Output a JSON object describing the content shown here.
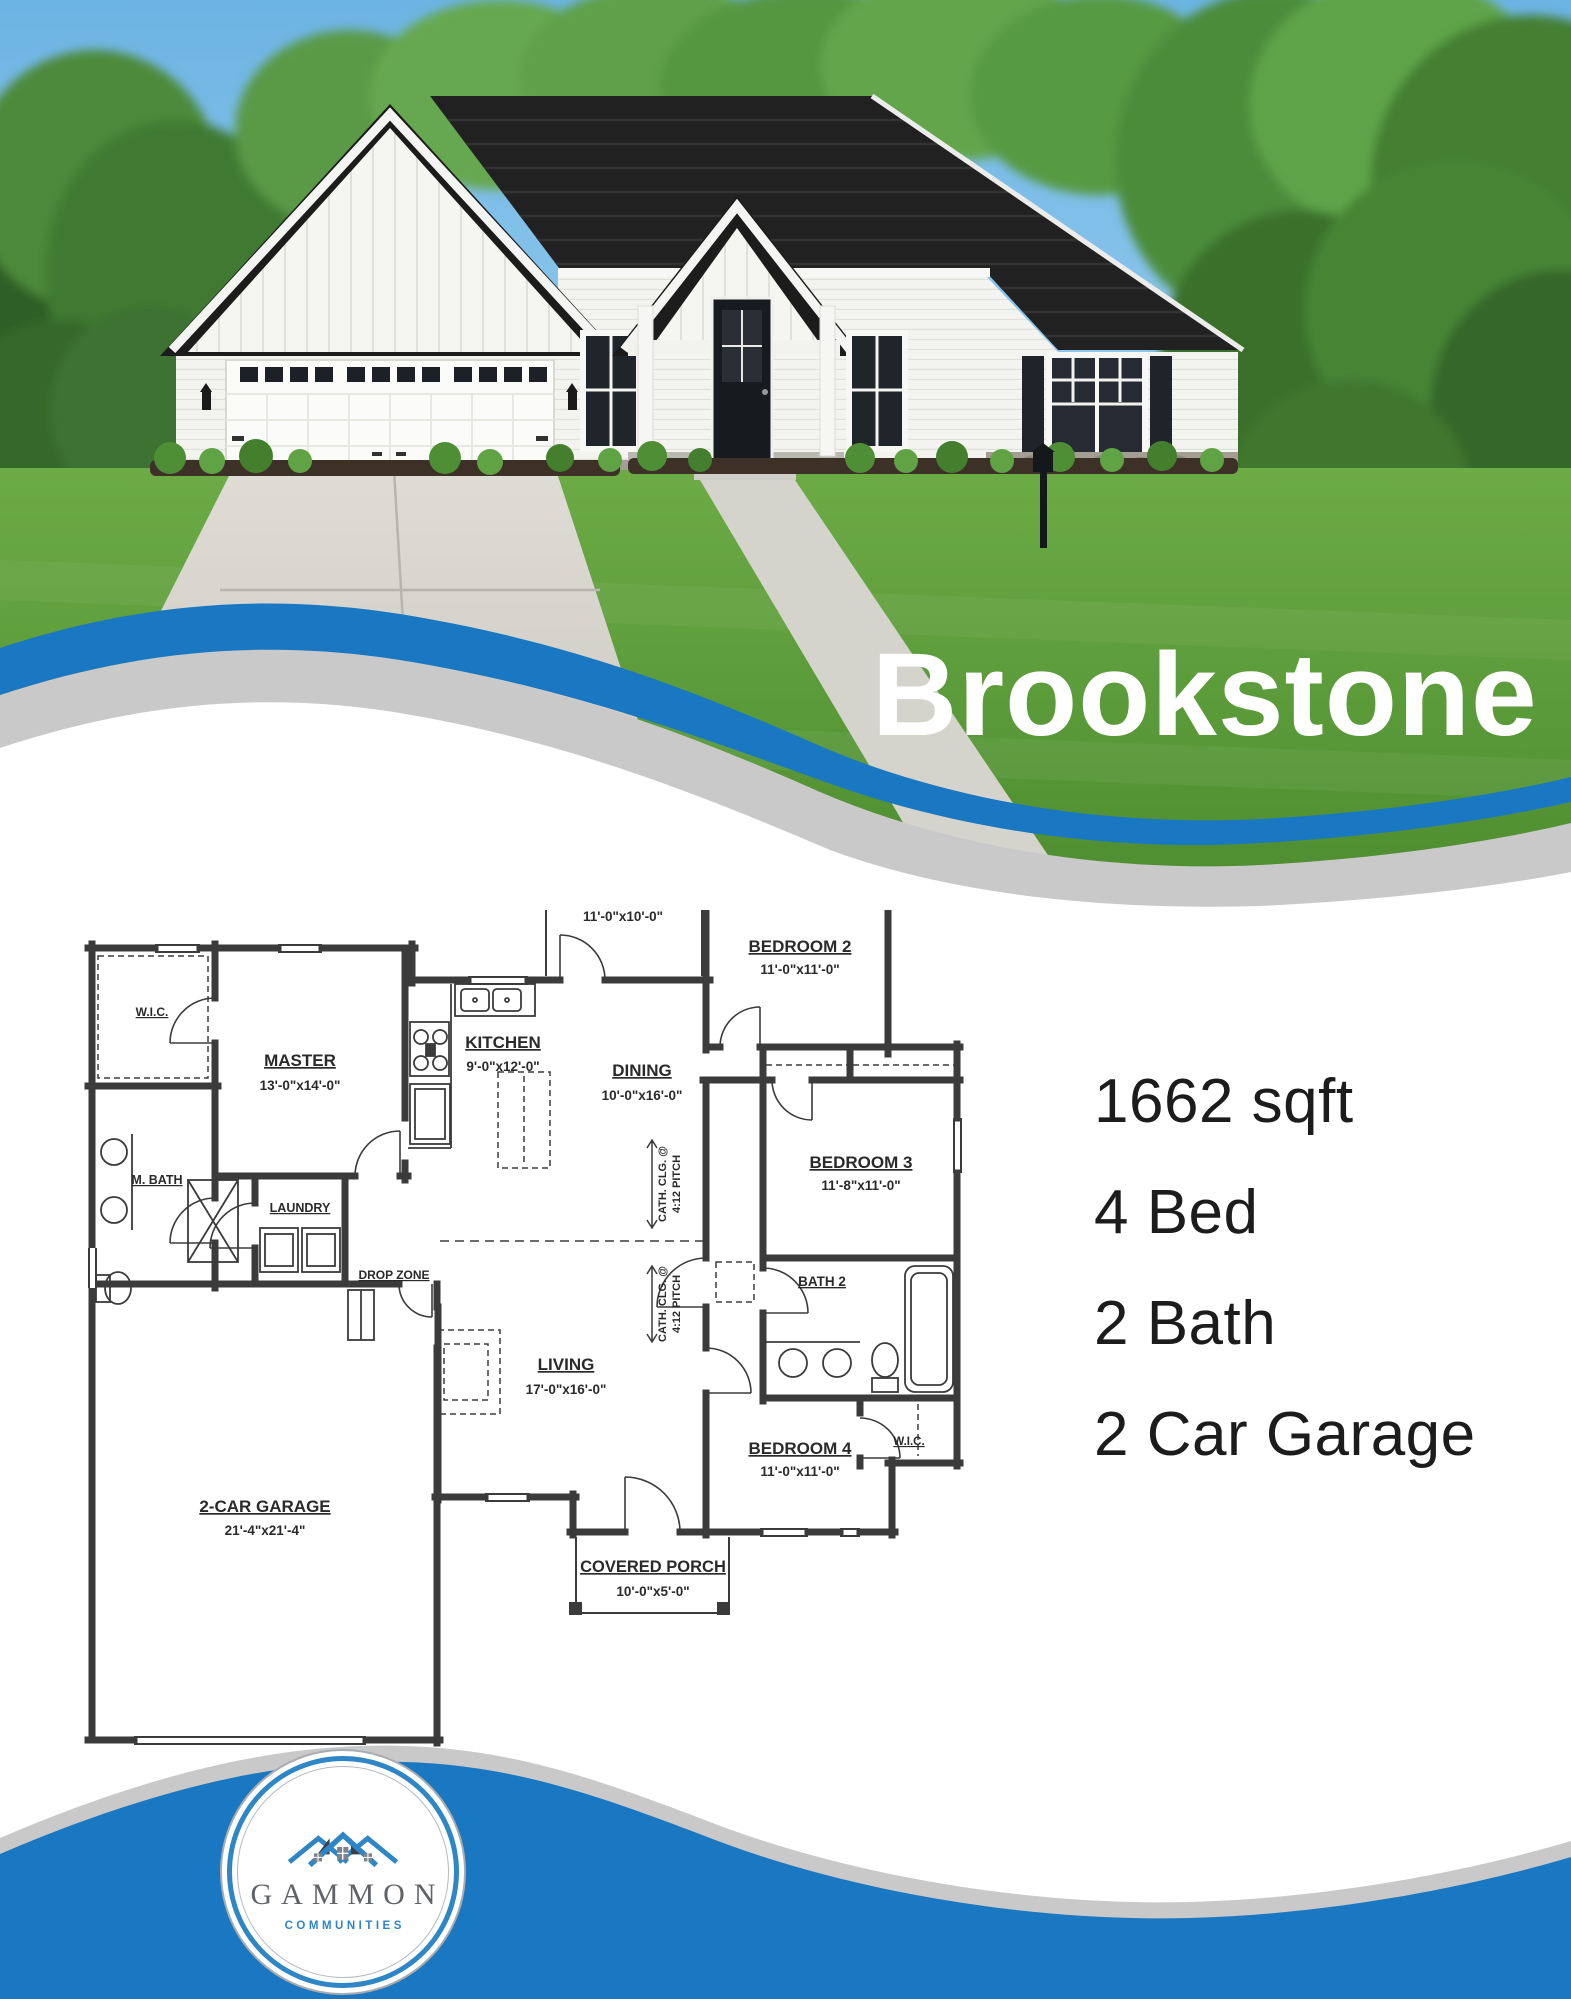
{
  "header": {
    "title": "Brookstone"
  },
  "specs": {
    "sqft": "1662 sqft",
    "beds": "4 Bed",
    "baths": "2 Bath",
    "garage": "2 Car Garage"
  },
  "floor_plan": {
    "rooms": {
      "cov_patio": {
        "name": "COV. PATIO",
        "dim": "11'-0\"x10'-0\""
      },
      "bedroom2": {
        "name": "BEDROOM 2",
        "dim": "11'-0\"x11'-0\""
      },
      "bedroom3": {
        "name": "BEDROOM 3",
        "dim": "11'-8\"x11'-0\""
      },
      "bedroom4": {
        "name": "BEDROOM 4",
        "dim": "11'-0\"x11'-0\""
      },
      "bath2": {
        "name": "BATH 2"
      },
      "wic_master": {
        "name": "W.I.C."
      },
      "wic_bed4": {
        "name": "W.I.C."
      },
      "master": {
        "name": "MASTER",
        "dim": "13'-0\"x14'-0\""
      },
      "m_bath": {
        "name": "M. BATH"
      },
      "laundry": {
        "name": "LAUNDRY"
      },
      "drop_zone": {
        "name": "DROP ZONE"
      },
      "kitchen": {
        "name": "KITCHEN",
        "dim": "9'-0\"x12'-0\""
      },
      "dining": {
        "name": "DINING",
        "dim": "10'-0\"x16'-0\""
      },
      "living": {
        "name": "LIVING",
        "dim": "17'-0\"x16'-0\""
      },
      "garage": {
        "name": "2-CAR GARAGE",
        "dim": "21'-4\"x21'-4\""
      },
      "covered_porch": {
        "name": "COVERED PORCH",
        "dim": "10'-0\"x5'-0\""
      }
    },
    "ceiling_note": {
      "line1": "CATH. CLG. @",
      "line2": "4:12 PITCH"
    }
  },
  "logo": {
    "name": "GAMMON",
    "tagline": "COMMUNITIES"
  },
  "colors": {
    "brand_blue": "#1a78c2",
    "wave_gray": "#c9c9c9",
    "plan_line": "#3b3b3b",
    "text_dark": "#1c1c1c",
    "logo_blue": "#2e86c6",
    "logo_gray": "#5f6367"
  }
}
